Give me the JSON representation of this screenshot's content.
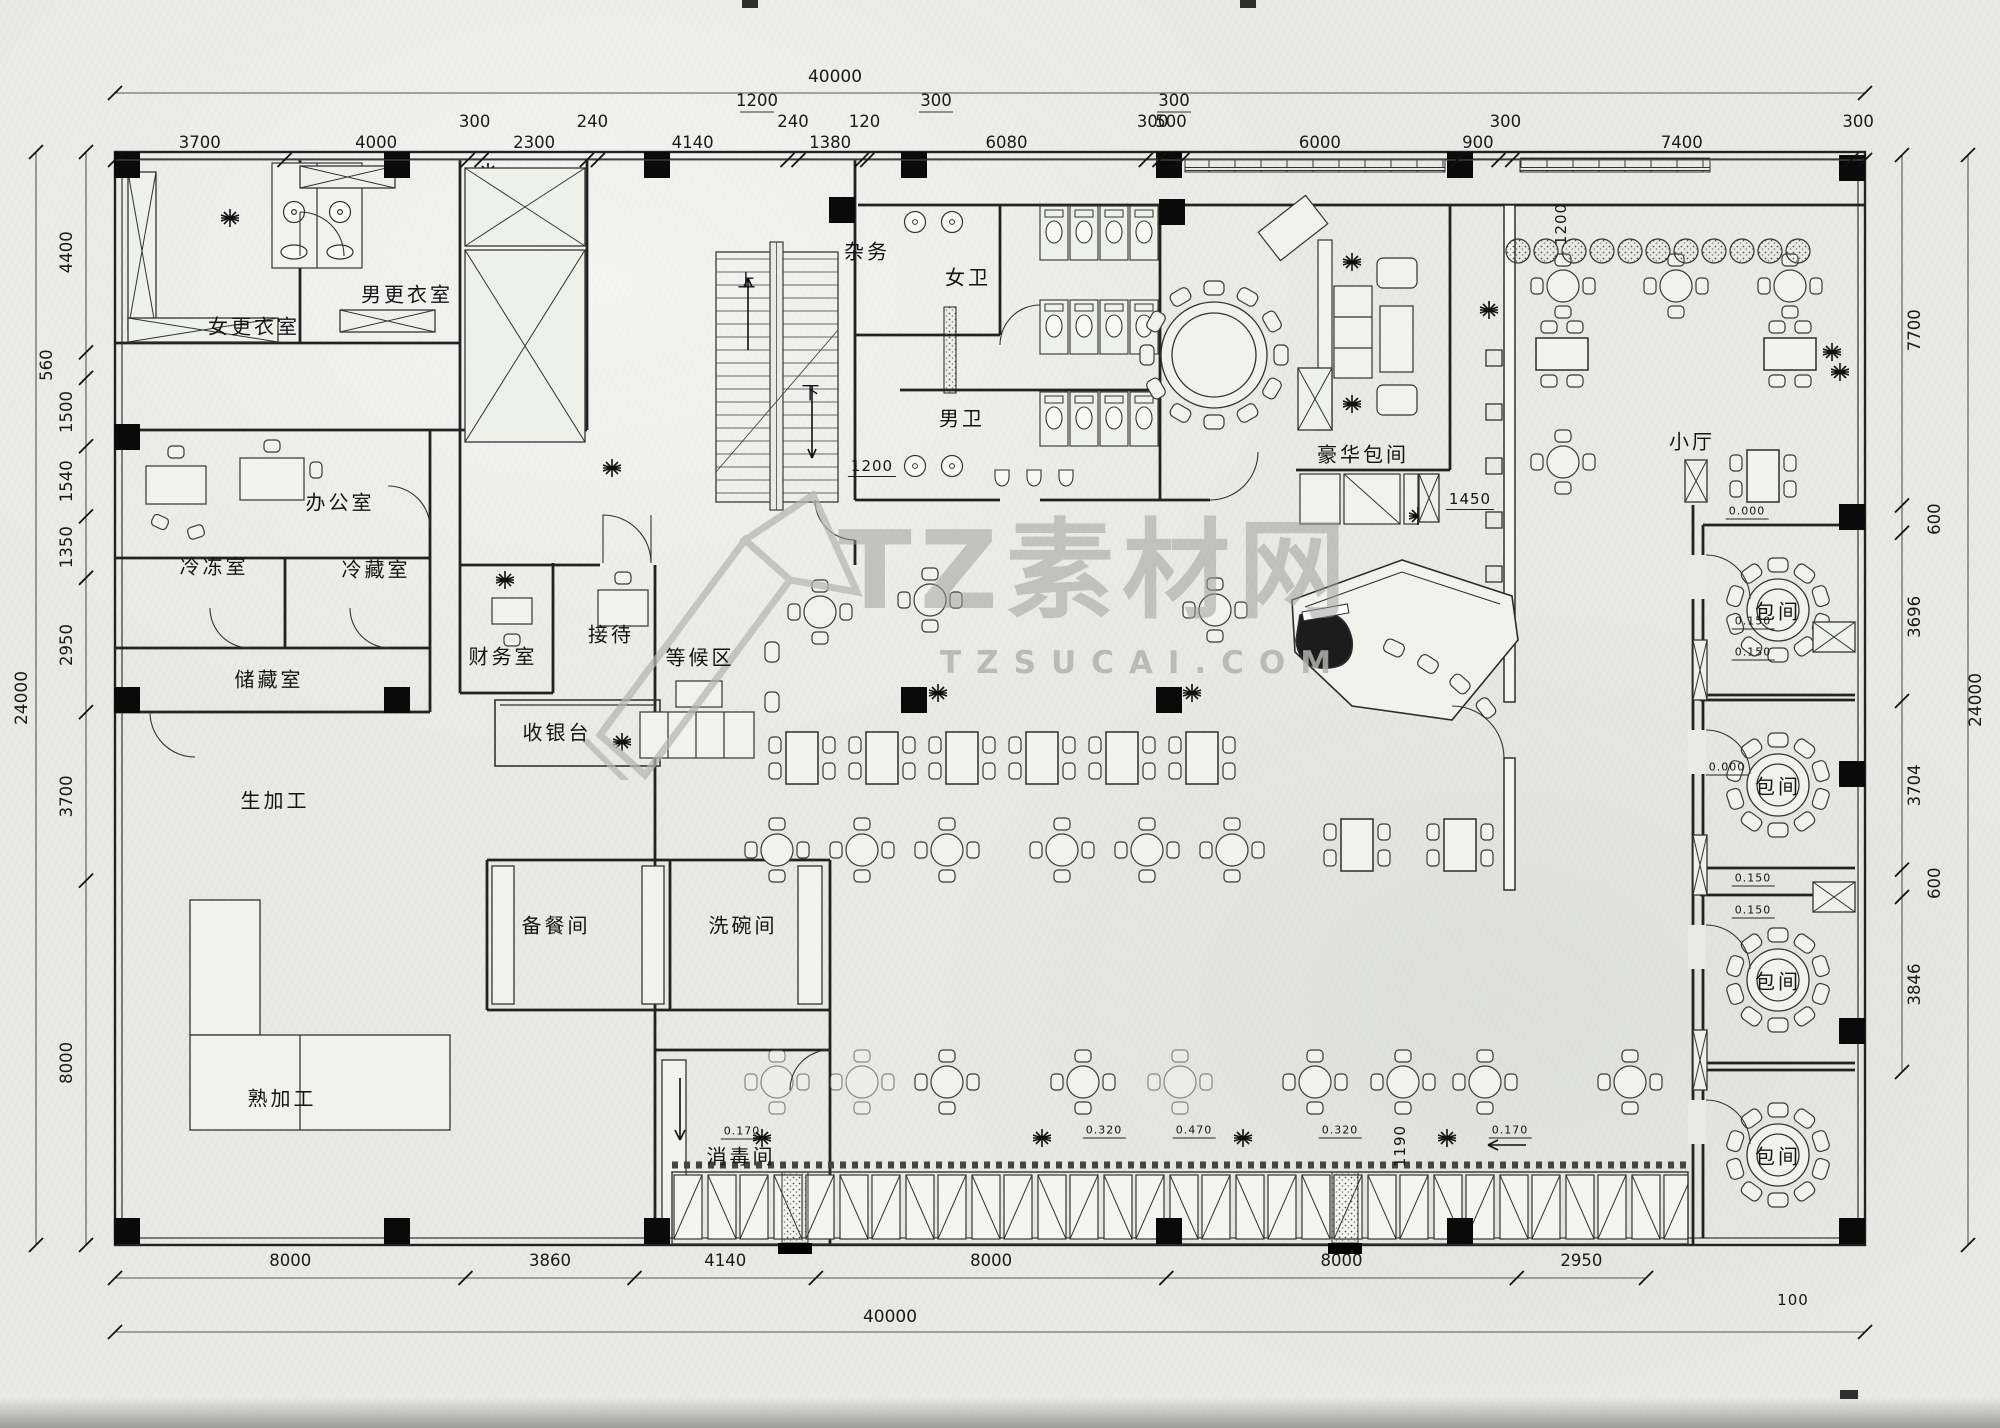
{
  "watermark": {
    "brand": "TZ素材网",
    "site": "TZSUCAI.COM"
  },
  "plan": {
    "overall_width_mm": "40000",
    "overall_height_mm": "24000"
  },
  "rooms": [
    {
      "id": "women-locker",
      "t": "女更衣室",
      "x": 254,
      "y": 325
    },
    {
      "id": "men-locker",
      "t": "男更衣室",
      "x": 407,
      "y": 293
    },
    {
      "id": "office",
      "t": "办公室",
      "x": 340,
      "y": 501
    },
    {
      "id": "freezer",
      "t": "冷冻室",
      "x": 214,
      "y": 565
    },
    {
      "id": "cold-storage",
      "t": "冷藏室",
      "x": 376,
      "y": 568
    },
    {
      "id": "storage",
      "t": "储藏室",
      "x": 269,
      "y": 678
    },
    {
      "id": "finance",
      "t": "财务室",
      "x": 503,
      "y": 655
    },
    {
      "id": "reception",
      "t": "接待",
      "x": 611,
      "y": 633
    },
    {
      "id": "waiting-area",
      "t": "等候区",
      "x": 700,
      "y": 656
    },
    {
      "id": "cashier",
      "t": "收银台",
      "x": 557,
      "y": 731
    },
    {
      "id": "raw-processing",
      "t": "生加工",
      "x": 275,
      "y": 799
    },
    {
      "id": "cooked-processing",
      "t": "熟加工",
      "x": 282,
      "y": 1097
    },
    {
      "id": "pantry",
      "t": "备餐间",
      "x": 556,
      "y": 924
    },
    {
      "id": "dishwashing",
      "t": "洗碗间",
      "x": 743,
      "y": 924
    },
    {
      "id": "disinfection",
      "t": "消毒间",
      "x": 741,
      "y": 1155
    },
    {
      "id": "utility",
      "t": "杂务",
      "x": 867,
      "y": 250
    },
    {
      "id": "women-wc",
      "t": "女卫",
      "x": 968,
      "y": 276
    },
    {
      "id": "men-wc",
      "t": "男卫",
      "x": 962,
      "y": 417
    },
    {
      "id": "deluxe-private-room",
      "t": "豪华包间",
      "x": 1363,
      "y": 453
    },
    {
      "id": "small-hall",
      "t": "小厅",
      "x": 1692,
      "y": 440
    },
    {
      "id": "private-room-1",
      "t": "包间",
      "x": 1778,
      "y": 610
    },
    {
      "id": "private-room-2",
      "t": "包间",
      "x": 1778,
      "y": 785
    },
    {
      "id": "private-room-3",
      "t": "包间",
      "x": 1778,
      "y": 980
    },
    {
      "id": "private-room-4",
      "t": "包间",
      "x": 1778,
      "y": 1155
    },
    {
      "id": "stair-up",
      "t": "上",
      "x": 748,
      "y": 280,
      "fs": 18
    },
    {
      "id": "stair-down",
      "t": "下",
      "x": 812,
      "y": 392,
      "fs": 18
    }
  ],
  "annotations": [
    {
      "id": "dim-1200-stair",
      "t": "1200",
      "x": 872,
      "y": 467,
      "u": true
    },
    {
      "id": "dim-1200-band",
      "t": "1200",
      "x": 1561,
      "y": 224,
      "rot": true
    },
    {
      "id": "dim-1450",
      "t": "1450",
      "x": 1470,
      "y": 500,
      "u": true
    },
    {
      "id": "dim-1190",
      "t": "1190",
      "x": 1400,
      "y": 1146,
      "rot": true
    },
    {
      "id": "lvl-0000-a",
      "t": "0.000",
      "x": 1747,
      "y": 512,
      "fs": 11,
      "u": true
    },
    {
      "id": "lvl-0150-a",
      "t": "0.150",
      "x": 1753,
      "y": 622,
      "fs": 11,
      "u": true
    },
    {
      "id": "lvl-0150-b",
      "t": "0.150",
      "x": 1753,
      "y": 653,
      "fs": 11,
      "u": true
    },
    {
      "id": "lvl-0000-b",
      "t": "0.000",
      "x": 1727,
      "y": 768,
      "fs": 11,
      "u": true
    },
    {
      "id": "lvl-0150-c",
      "t": "0.150",
      "x": 1753,
      "y": 879,
      "fs": 11,
      "u": true
    },
    {
      "id": "lvl-0150-d",
      "t": "0.150",
      "x": 1753,
      "y": 911,
      "fs": 11,
      "u": true
    },
    {
      "id": "lvl-0170-a",
      "t": "0.170",
      "x": 742,
      "y": 1132,
      "fs": 11,
      "u": true
    },
    {
      "id": "lvl-0320-a",
      "t": "0.320",
      "x": 1104,
      "y": 1131,
      "fs": 11,
      "u": true
    },
    {
      "id": "lvl-0470",
      "t": "0.470",
      "x": 1194,
      "y": 1131,
      "fs": 11,
      "u": true
    },
    {
      "id": "lvl-0320-b",
      "t": "0.320",
      "x": 1340,
      "y": 1131,
      "fs": 11,
      "u": true
    },
    {
      "id": "lvl-0170-b",
      "t": "0.170",
      "x": 1510,
      "y": 1131,
      "fs": 11,
      "u": true
    },
    {
      "id": "dim-100",
      "t": "100",
      "x": 1793,
      "y": 1300
    }
  ],
  "dimensions": {
    "top": {
      "overall": "40000",
      "sub": [
        {
          "t": "1200",
          "x": 757
        },
        {
          "t": "300",
          "x": 936
        },
        {
          "t": "300",
          "x": 1174
        }
      ],
      "segments": [
        "3700",
        "4000",
        "300",
        "2300",
        "240",
        "4140",
        "240",
        "1380",
        "120",
        "6080",
        "300",
        "500",
        "6000",
        "900",
        "300",
        "7400",
        "300"
      ]
    },
    "bottom": {
      "overall": "40000",
      "segments": [
        "8000",
        "3860",
        "4140",
        "8000",
        "8000",
        "2950"
      ]
    },
    "left": {
      "overall": "24000",
      "segments": [
        "4400",
        "560",
        "1500",
        "1540",
        "1350",
        "2950",
        "3700",
        "8000"
      ]
    },
    "right": {
      "overall": "24000",
      "segments": [
        "7700",
        "600",
        "3696",
        "3704",
        "600",
        "3846"
      ]
    }
  }
}
